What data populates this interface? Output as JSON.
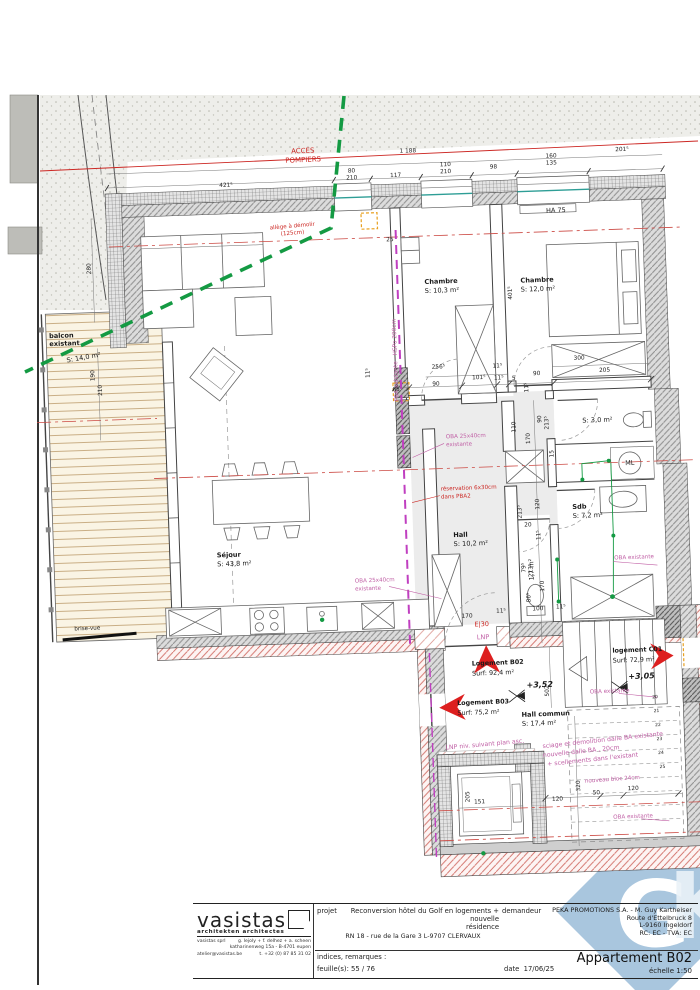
{
  "colors": {
    "red": "#cc2723",
    "pink": "#c05fa5",
    "ink": "#1a1a1a",
    "dim": "#222222",
    "green": "#149a43",
    "teal": "#2e9e96",
    "orange": "#e8a020",
    "watermark": "#a9c6de",
    "arrow": "#dd1f1f"
  },
  "watermark": {
    "letters_g": "G",
    "letters_k": "K"
  },
  "access_route": {
    "line1": "ACCES",
    "line2": "POMPIERS"
  },
  "plan": {
    "rooms": [
      {
        "n": "Séjour",
        "a": "S: 43,8 m²",
        "x": 215,
        "y": 551
      },
      {
        "n": "balcon",
        "a": "",
        "x": 55,
        "y": 326
      },
      {
        "n": "existant",
        "a": "",
        "x": 55,
        "y": 334
      },
      {
        "n": "",
        "a": "S: 14,0 m²",
        "x": 72,
        "y": 351,
        "r": -8
      },
      {
        "n": "Chambre",
        "a": "S: 10,3 m²",
        "x": 432,
        "y": 285
      },
      {
        "n": "Chambre",
        "a": "S: 12,0 m²",
        "x": 528,
        "y": 287
      },
      {
        "n": "",
        "a": "S: 3,0 m²",
        "x": 585,
        "y": 429
      },
      {
        "n": "Sdb",
        "a": "S: 7,2 m²",
        "x": 572,
        "y": 515
      },
      {
        "n": "Hall",
        "a": "S: 10,2 m²",
        "x": 452,
        "y": 539
      },
      {
        "n": "",
        "a": "1,7 m²",
        "x": 531,
        "y": 585,
        "r": -90
      },
      {
        "n": "Hall commun",
        "a": "S: 17,4 m²",
        "x": 514,
        "y": 721
      }
    ],
    "apartments": [
      {
        "n": "Logement B02",
        "a": "Surf: 92,4 m²",
        "x": 466,
        "y": 668
      },
      {
        "n": "Logement B03",
        "a": "Surf: 75,2 m²",
        "x": 450,
        "y": 707
      },
      {
        "n": "logement C01",
        "a": "Surf: 72,9 m²",
        "x": 607,
        "y": 660
      }
    ],
    "levels": [
      {
        "t": "+3,52",
        "x": 520,
        "y": 692
      },
      {
        "t": "+3,05",
        "x": 622,
        "y": 687
      }
    ],
    "annotations": [
      {
        "t": "allège à démolir",
        "x": 302,
        "y": 224,
        "c": "red",
        "s": 5.6,
        "a": "middle",
        "r": -3
      },
      {
        "t": "(125cm)",
        "x": 302,
        "y": 231,
        "c": "red",
        "s": 5.6,
        "a": "middle",
        "r": -3
      },
      {
        "t": "E|30",
        "x": 470,
        "y": 629,
        "c": "red",
        "s": 6.5
      },
      {
        "t": "LNP",
        "x": 472,
        "y": 642,
        "c": "pink",
        "s": 6.5
      },
      {
        "t": "réservation 6x30cm",
        "x": 441,
        "y": 492,
        "c": "red",
        "s": 5.6
      },
      {
        "t": "dans PBA2",
        "x": 441,
        "y": 500,
        "c": "red",
        "s": 5.6
      },
      {
        "t": "PBA existante - HSPo 200cm",
        "x": 402,
        "y": 360,
        "c": "pink",
        "s": 5.8,
        "r": -90,
        "a": "middle"
      },
      {
        "t": "OBA 25x40cm",
        "x": 448,
        "y": 440,
        "c": "pink",
        "s": 5.6
      },
      {
        "t": "existante",
        "x": 448,
        "y": 448,
        "c": "pink",
        "s": 5.6
      },
      {
        "t": "OBA 25x40cm",
        "x": 352,
        "y": 581,
        "c": "pink",
        "s": 5.6
      },
      {
        "t": "existante",
        "x": 352,
        "y": 589,
        "c": "pink",
        "s": 5.6
      },
      {
        "t": "OBA existante",
        "x": 612,
        "y": 567,
        "c": "pink",
        "s": 5.6
      },
      {
        "t": "OBA existante",
        "x": 583,
        "y": 700,
        "c": "pink",
        "s": 5.6
      },
      {
        "t": "OBA existante",
        "x": 602,
        "y": 826,
        "c": "pink",
        "s": 5.6
      },
      {
        "t": "LNP niv. suivant plan asc.",
        "x": 437,
        "y": 751,
        "c": "pink",
        "s": 6.2,
        "r": -3
      },
      {
        "t": "sciage et démolition dalle BA existante",
        "x": 534,
        "y": 753,
        "c": "pink",
        "s": 6.2,
        "r": -4
      },
      {
        "t": "nouvelle dalle BA , 20cm",
        "x": 534,
        "y": 762,
        "c": "pink",
        "s": 6.2,
        "r": -4
      },
      {
        "t": "+ scellements dans l'existant",
        "x": 538,
        "y": 771,
        "c": "pink",
        "s": 6.2,
        "r": -4
      },
      {
        "t": "nouveau bloc 24cm",
        "x": 575,
        "y": 789,
        "c": "pink",
        "s": 5.6,
        "r": -2
      },
      {
        "t": "HA 75",
        "x": 556,
        "y": 218,
        "c": "ink",
        "s": 6.5
      },
      {
        "t": "ML",
        "x": 631,
        "y": 473,
        "c": "ink",
        "s": 6.5,
        "a": "middle"
      },
      {
        "t": "brise-vue",
        "x": 70,
        "y": 619,
        "c": "ink",
        "s": 5.6
      }
    ],
    "dimensions": [
      {
        "v": "421⁵",
        "x": 237,
        "y": 181
      },
      {
        "v": "80",
        "x": 363,
        "y": 171
      },
      {
        "v": "210",
        "x": 363,
        "y": 178
      },
      {
        "v": "117",
        "x": 407,
        "y": 177
      },
      {
        "v": "110",
        "x": 457,
        "y": 168
      },
      {
        "v": "210",
        "x": 457,
        "y": 175
      },
      {
        "v": "98",
        "x": 505,
        "y": 172
      },
      {
        "v": "160",
        "x": 563,
        "y": 163
      },
      {
        "v": "135",
        "x": 563,
        "y": 170
      },
      {
        "v": "201⁵",
        "x": 634,
        "y": 159
      },
      {
        "v": "1 188",
        "x": 420,
        "y": 153
      },
      {
        "v": "280",
        "x": 99,
        "y": 258,
        "r": -90
      },
      {
        "v": "190",
        "x": 99,
        "y": 365,
        "r": -90
      },
      {
        "v": "210",
        "x": 106,
        "y": 380,
        "r": -90
      },
      {
        "v": "25",
        "x": 399,
        "y": 241
      },
      {
        "v": "401⁵",
        "x": 519,
        "y": 297,
        "r": -90
      },
      {
        "v": "11⁵",
        "x": 374,
        "y": 372,
        "r": -90
      },
      {
        "v": "256⁵",
        "x": 443,
        "y": 370
      },
      {
        "v": "90",
        "x": 440,
        "y": 387
      },
      {
        "v": "101⁵",
        "x": 483,
        "y": 382
      },
      {
        "v": "11⁵",
        "x": 502,
        "y": 371
      },
      {
        "v": "11⁵",
        "x": 503,
        "y": 383
      },
      {
        "v": "5",
        "x": 518,
        "y": 384
      },
      {
        "v": "90",
        "x": 541,
        "y": 380
      },
      {
        "v": "300",
        "x": 584,
        "y": 366
      },
      {
        "v": "205",
        "x": 609,
        "y": 379
      },
      {
        "v": "65",
        "x": 400,
        "y": 391
      },
      {
        "v": "11⁵",
        "x": 532,
        "y": 392,
        "r": -90
      },
      {
        "v": "110",
        "x": 518,
        "y": 431,
        "r": -90
      },
      {
        "v": "170",
        "x": 532,
        "y": 443,
        "r": -90
      },
      {
        "v": "90",
        "x": 544,
        "y": 424,
        "r": -90
      },
      {
        "v": "213⁵",
        "x": 551,
        "y": 428,
        "r": -90
      },
      {
        "v": "15",
        "x": 555,
        "y": 459,
        "r": -90
      },
      {
        "v": "120",
        "x": 539,
        "y": 509,
        "r": -90
      },
      {
        "v": "213⁵",
        "x": 521,
        "y": 516,
        "r": -90
      },
      {
        "v": "20",
        "x": 527,
        "y": 531
      },
      {
        "v": "11⁵",
        "x": 539,
        "y": 540,
        "r": -90
      },
      {
        "v": "79⁵",
        "x": 523,
        "y": 572,
        "r": -90
      },
      {
        "v": "213⁵",
        "x": 530,
        "y": 575,
        "r": -90
      },
      {
        "v": "170",
        "x": 541,
        "y": 591,
        "r": -90
      },
      {
        "v": "86⁵",
        "x": 527,
        "y": 602,
        "r": -90
      },
      {
        "v": "100",
        "x": 534,
        "y": 615
      },
      {
        "v": "11⁵",
        "x": 557,
        "y": 614
      },
      {
        "v": "170",
        "x": 463,
        "y": 620
      },
      {
        "v": "11⁵",
        "x": 497,
        "y": 616
      },
      {
        "v": "502",
        "x": 542,
        "y": 696,
        "r": -90
      },
      {
        "v": "151",
        "x": 469,
        "y": 806
      },
      {
        "v": "205",
        "x": 459,
        "y": 799,
        "r": -90
      },
      {
        "v": "320",
        "x": 570,
        "y": 792,
        "r": -90
      },
      {
        "v": "120",
        "x": 547,
        "y": 806
      },
      {
        "v": "50",
        "x": 586,
        "y": 801
      },
      {
        "v": "120",
        "x": 623,
        "y": 798
      },
      {
        "v": "20",
        "x": 648,
        "y": 707,
        "s": 4.5
      },
      {
        "v": "21",
        "x": 649,
        "y": 721,
        "s": 4.5
      },
      {
        "v": "22",
        "x": 650,
        "y": 735,
        "s": 4.5
      },
      {
        "v": "23",
        "x": 651,
        "y": 749,
        "s": 4.5
      },
      {
        "v": "24",
        "x": 652,
        "y": 763,
        "s": 4.5
      },
      {
        "v": "25",
        "x": 653,
        "y": 777,
        "s": 4.5
      }
    ]
  },
  "title_block": {
    "firm_name": "vasistas",
    "firm_tagline": "architekten architectes",
    "firm_l1a": "vasistas sprl",
    "firm_l1b": "g. lejoly + f. delhez + a. scheen",
    "firm_l2": "katharinenweg 15a - B-4701 eupen",
    "firm_l3a": "atelier@vasistas.be",
    "firm_l3b": "t. +32 (0) 87 85 31 02",
    "project_label": "projet",
    "project_name1": "Reconversion hôtel du Golf en logements + nouvelle",
    "project_name2": "résidence",
    "project_address": "RN 18 - rue de la Gare 3   L-9707 CLERVAUX",
    "client_label": "demandeur",
    "client_1": "PEKA PROMOTIONS S.A. - M. Guy Kartheiser",
    "client_2": "Route d'Ettelbruck 8",
    "client_3": "L-9160 Ingeldorf",
    "client_4": "RC: EC - TVA: EC",
    "notes_label": "indices, remarques :",
    "sheet_label": "feuille(s): 55 / 76",
    "date_label": "date",
    "date_value": "17/06/25",
    "doc_title": "Appartement B02",
    "scale_label": "échelle  1:50"
  }
}
